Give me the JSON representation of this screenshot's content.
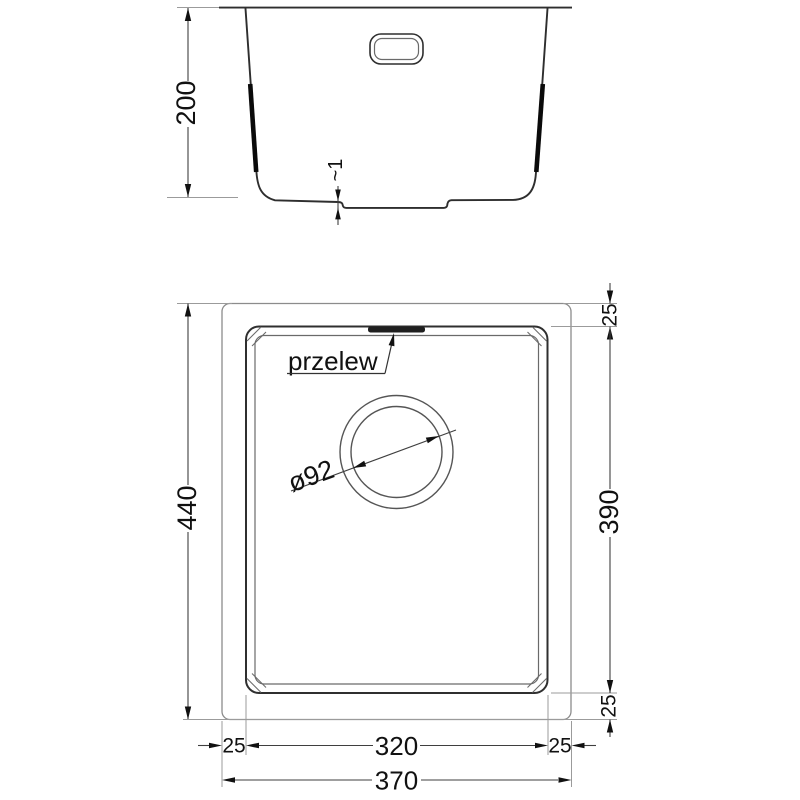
{
  "colors": {
    "background": "#ffffff",
    "outline": "#2e2e2e",
    "dimension_line": "#3f3f3f",
    "extension_line": "#9b9b9b",
    "text": "#111111",
    "overflow_slot_fill": "#1f1f1f"
  },
  "section_view": {
    "dimensions": {
      "depth": "200",
      "base_recess": "~1"
    }
  },
  "plan_view": {
    "labels": {
      "overflow": "przelew",
      "drain_diameter": "ø92"
    },
    "dimensions": {
      "overall_height": "440",
      "overall_width": "370",
      "bowl_width": "320",
      "bowl_height": "390",
      "rim_top": "25",
      "rim_bottom": "25",
      "rim_left": "25",
      "rim_right": "25"
    }
  }
}
